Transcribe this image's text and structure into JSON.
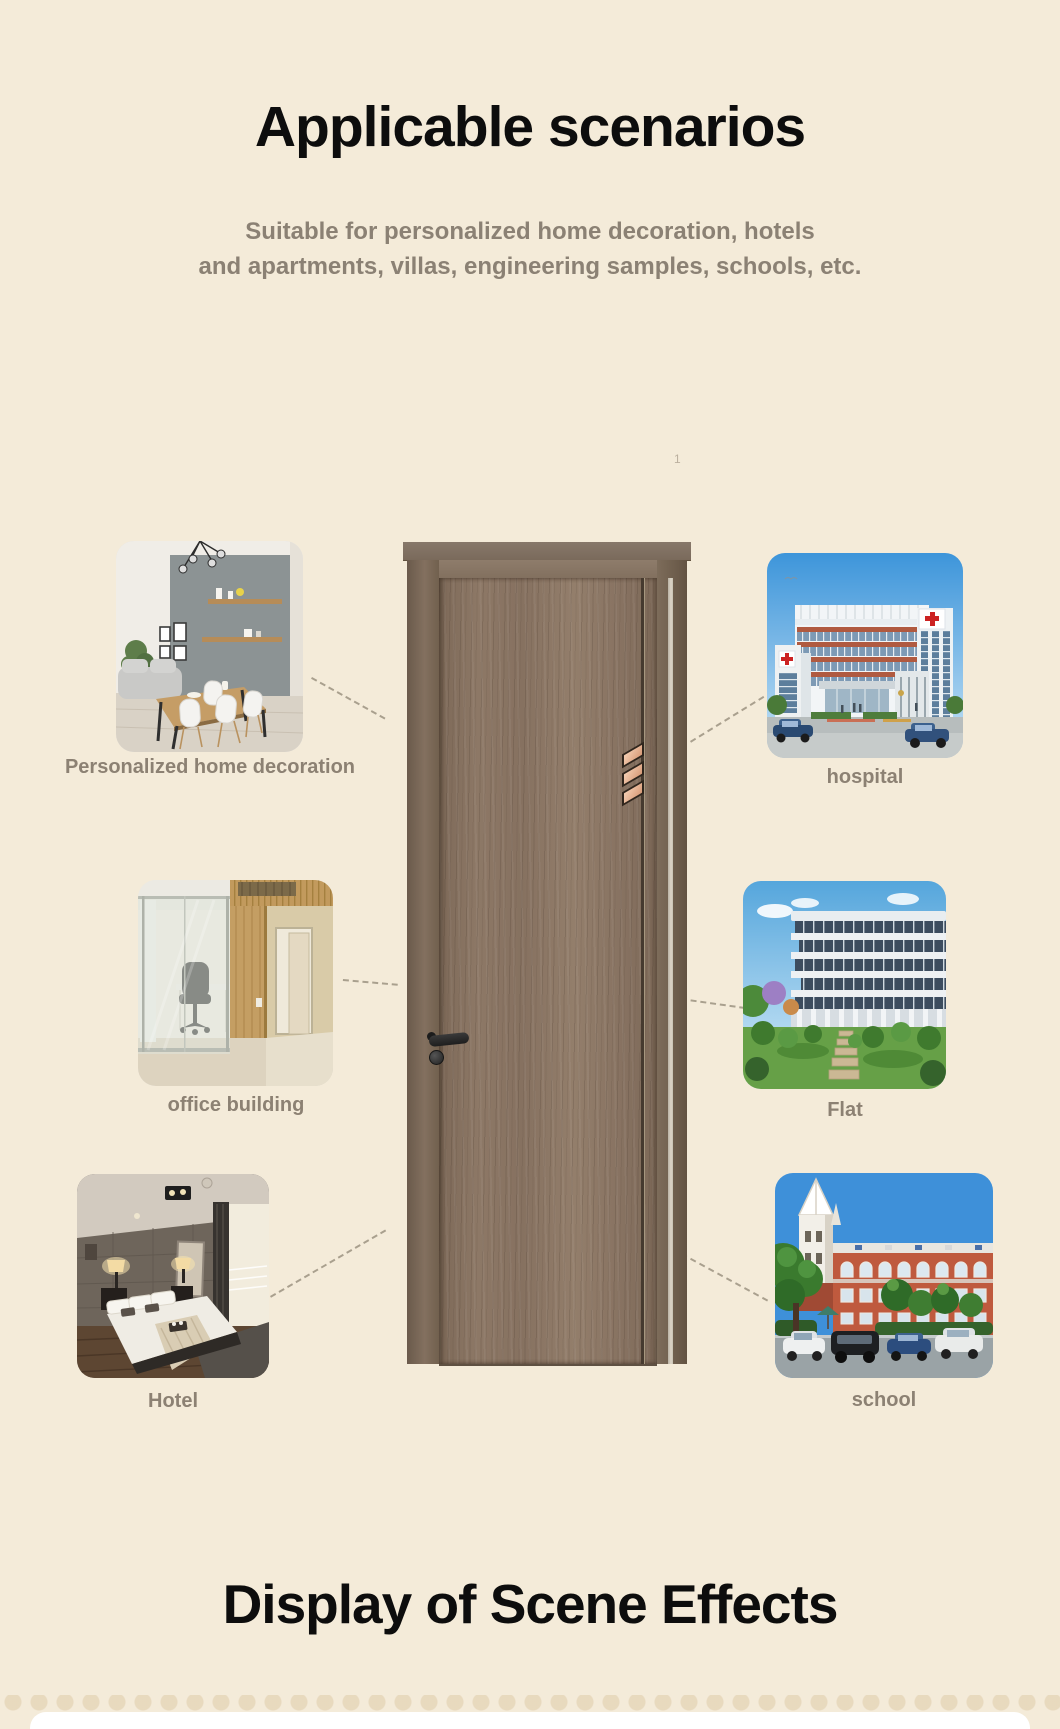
{
  "page": {
    "background_color": "#f4ebd9",
    "title": "Applicable scenarios",
    "subtitle_line1": "Suitable for personalized home decoration, hotels",
    "subtitle_line2": "and apartments, villas, engineering samples, schools, etc.",
    "stray_mark": "1",
    "footer_title": "Display of Scene Effects"
  },
  "door": {
    "wood_color": "#8c7766",
    "frame_color": "#77675a",
    "insert_color": "#e9b894",
    "handle_color": "#262626"
  },
  "scenarios": [
    {
      "label": "Personalized home decoration"
    },
    {
      "label": "hospital"
    },
    {
      "label": "office building"
    },
    {
      "label": "Flat"
    },
    {
      "label": "Hotel"
    },
    {
      "label": "school"
    }
  ]
}
